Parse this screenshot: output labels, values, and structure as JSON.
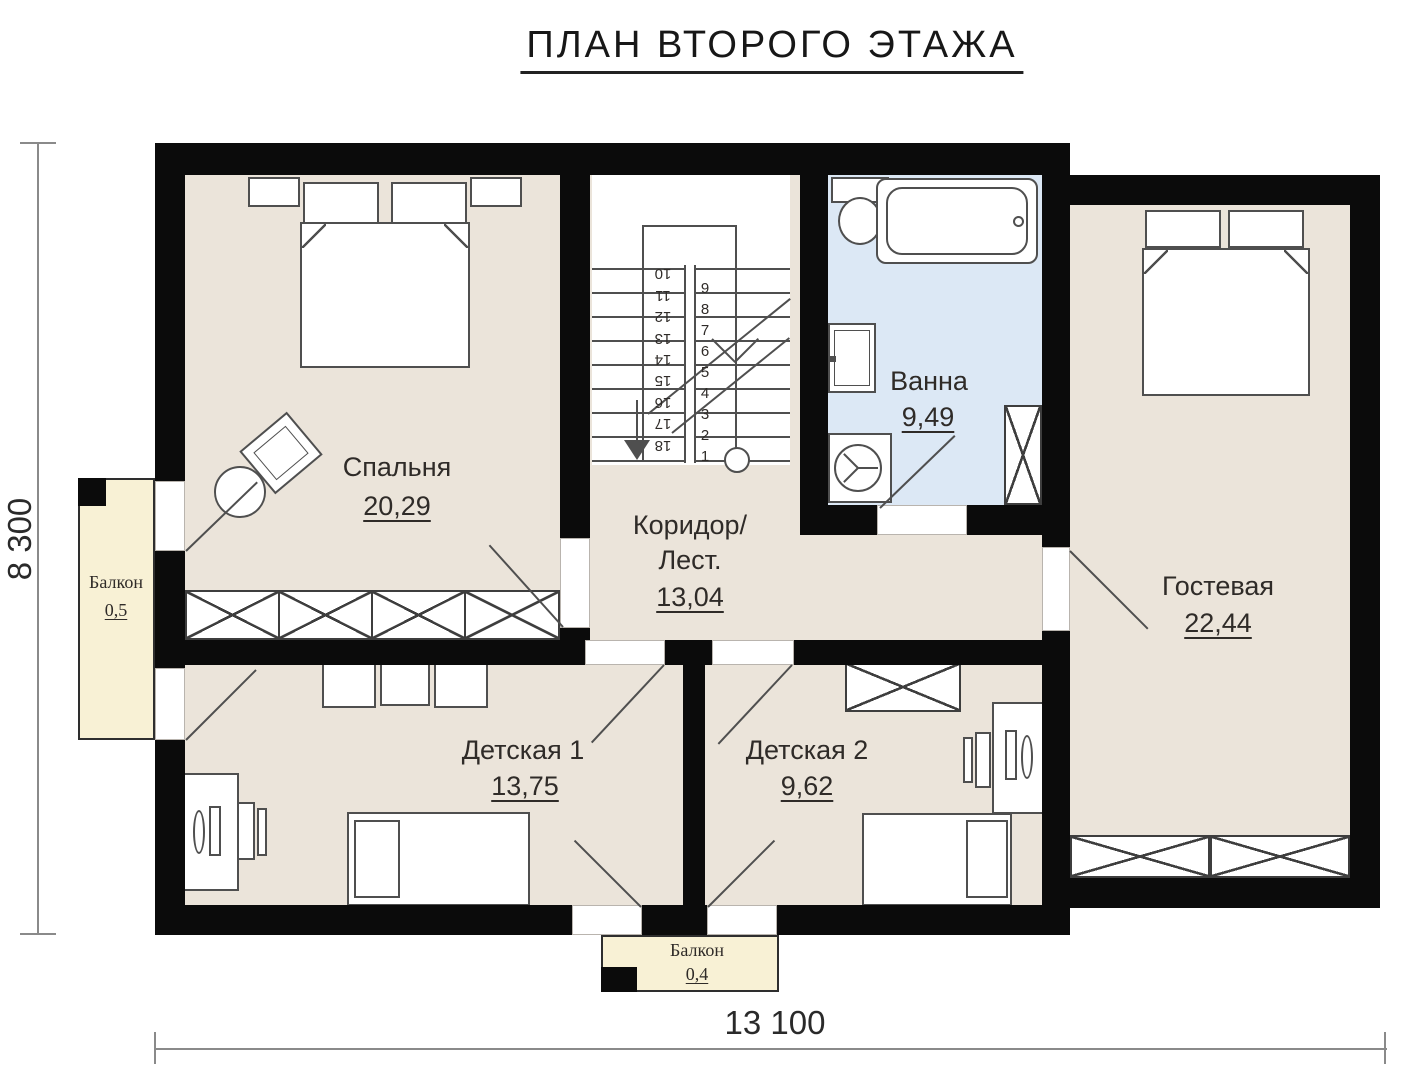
{
  "title": "ПЛАН ВТОРОГО ЭТАЖА",
  "rooms": {
    "bedroom": {
      "label": "Спальня",
      "area": "20,29"
    },
    "corridor": {
      "label_line1": "Коридор/",
      "label_line2": "Лест.",
      "area": "13,04"
    },
    "bathroom": {
      "label": "Ванна",
      "area": "9,49"
    },
    "guest": {
      "label": "Гостевая",
      "area": "22,44"
    },
    "kids1": {
      "label": "Детская 1",
      "area": "13,75"
    },
    "kids2": {
      "label": "Детская 2",
      "area": "9,62"
    }
  },
  "balconies": {
    "left": {
      "label": "Балкон",
      "area": "0,5"
    },
    "bottom": {
      "label": "Балкон",
      "area": "0,4"
    }
  },
  "dimensions": {
    "height_mm": "8 300",
    "width_mm": "13 100"
  },
  "stairs": {
    "left_numbers": [
      "10",
      "11",
      "12",
      "13",
      "14",
      "15",
      "16",
      "17",
      "18"
    ],
    "right_numbers": [
      "9",
      "8",
      "7",
      "6",
      "5",
      "4",
      "3",
      "2",
      "1"
    ]
  },
  "colors": {
    "wall": "#0b0b0b",
    "floor": "#ebe4da",
    "bath_floor": "#dce8f5",
    "balcony_floor": "#f8f1d5"
  }
}
